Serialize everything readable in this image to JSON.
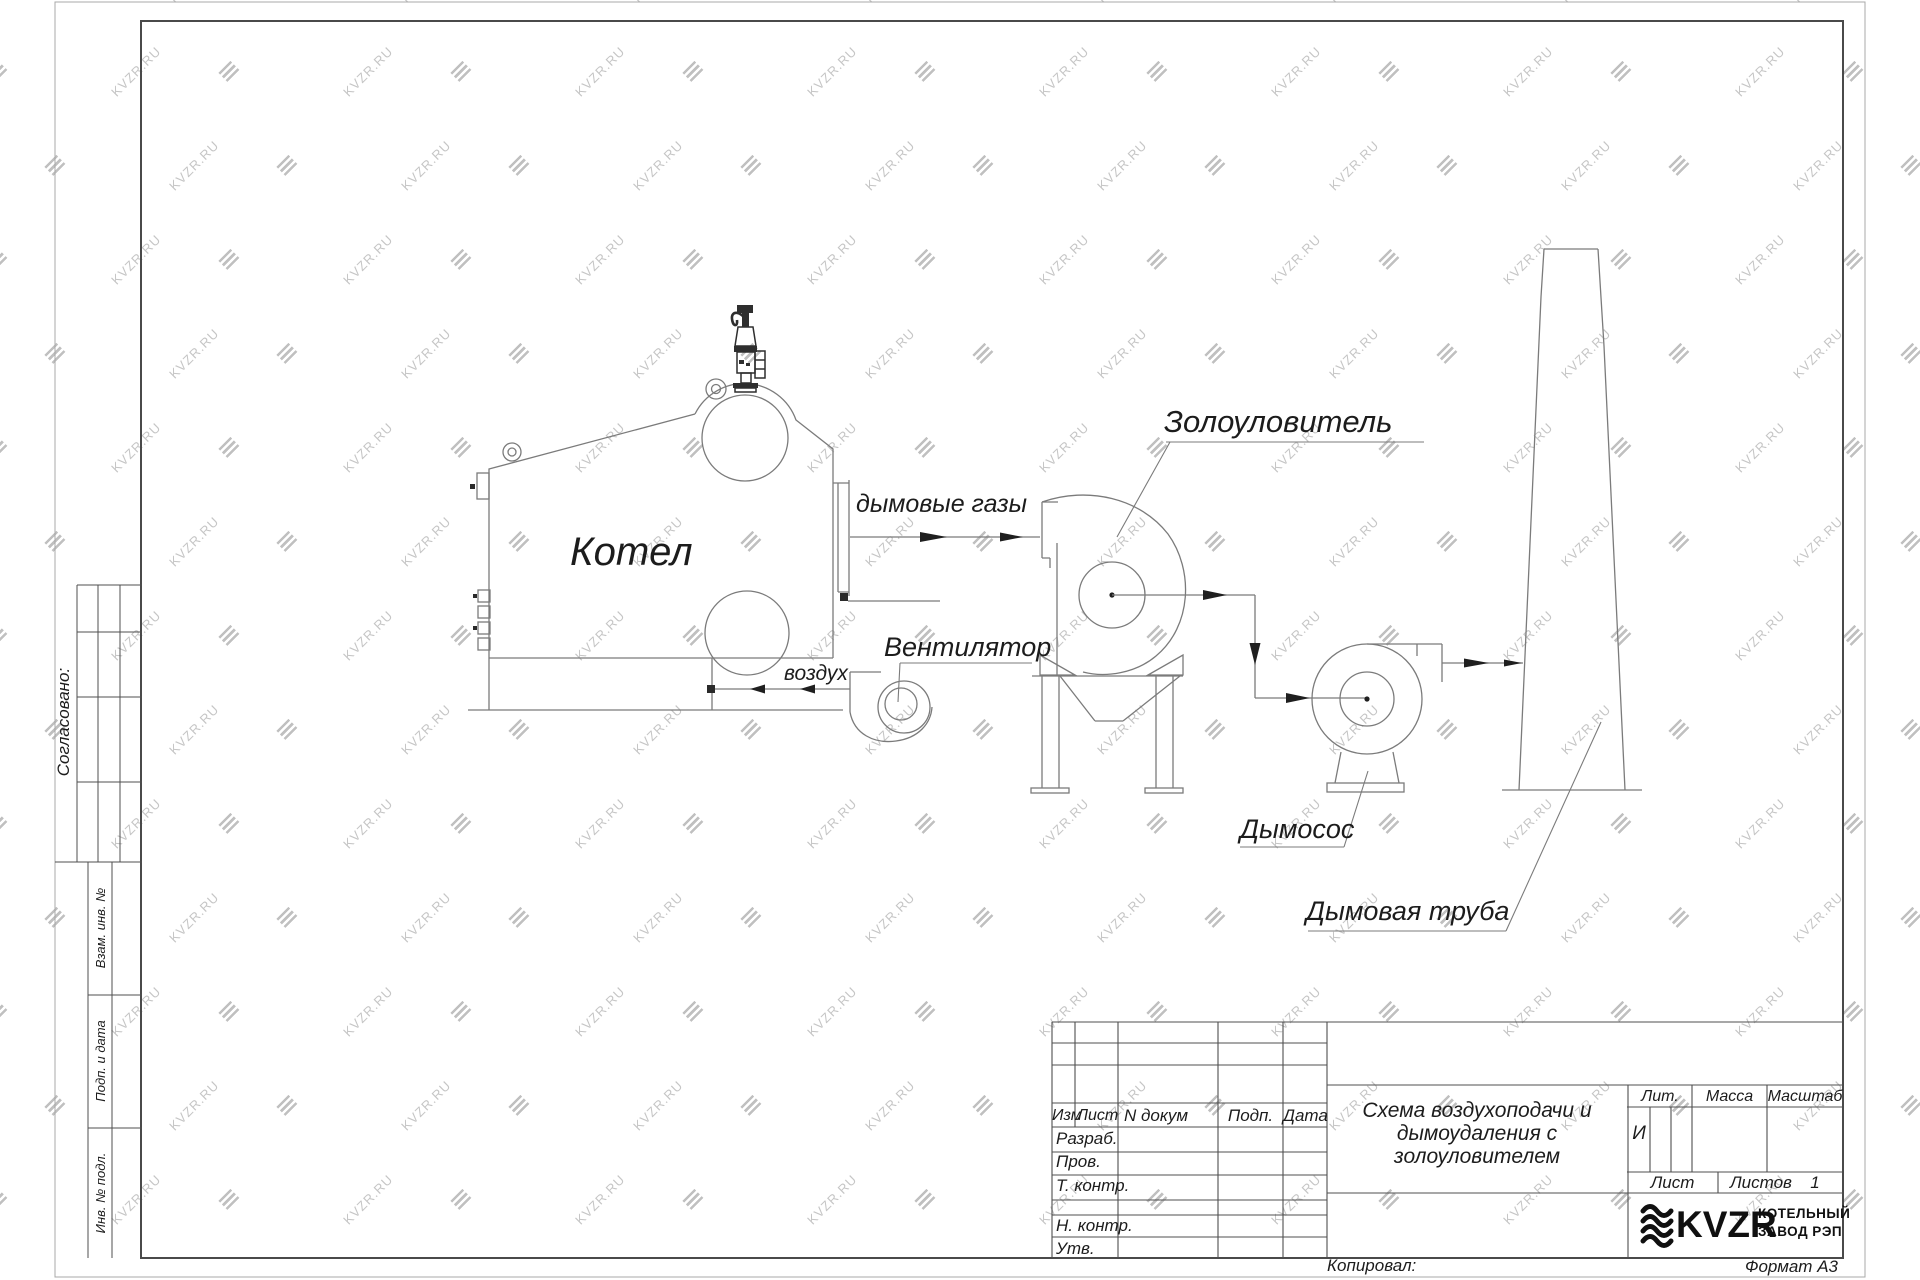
{
  "watermark": {
    "text": "KVZR.RU"
  },
  "colors": {
    "line": "#7b7b7b",
    "dark": "#2a2a2a",
    "frame": "#4a4a4a",
    "watermark": "#9f9f9f"
  },
  "drawing": {
    "labels": {
      "boiler": "Котел",
      "flue_gases": "дымовые газы",
      "fan": "Вентилятор",
      "air": "воздух",
      "ash_collector": "Золоуловитель",
      "smoke_exhauster": "Дымосос",
      "chimney": "Дымовая труба"
    }
  },
  "side_strip": {
    "agreed": "Согласовано:",
    "duplicate_inv": "Взам. инв. №",
    "sign_date": "Подп. и дата",
    "orig_inv": "Инв. № подл."
  },
  "title_block": {
    "columns": {
      "izm": "Изм",
      "list": "Лист",
      "doc": "N докум",
      "sign": "Подп.",
      "date": "Дата"
    },
    "rows": {
      "developed": "Разраб.",
      "checked": "Пров.",
      "t_control": "Т. контр.",
      "n_control": "Н. контр.",
      "approved": "Утв."
    },
    "title_line1": "Схема воздухоподачи и",
    "title_line2": "дымоудаления с",
    "title_line3": "золоуловителем",
    "lit_label": "Лит.",
    "lit_value": "И",
    "mass_label": "Масса",
    "scale_label": "Масштаб",
    "sheet_label": "Лист",
    "sheets_label": "Листов",
    "sheets_value": "1",
    "logo_text": "KVZR",
    "company_line1": "КОТЕЛЬНЫЙ",
    "company_line2": "ЗАВОД РЭП",
    "copied_label": "Копировал:",
    "format_label": "Формат А3"
  }
}
